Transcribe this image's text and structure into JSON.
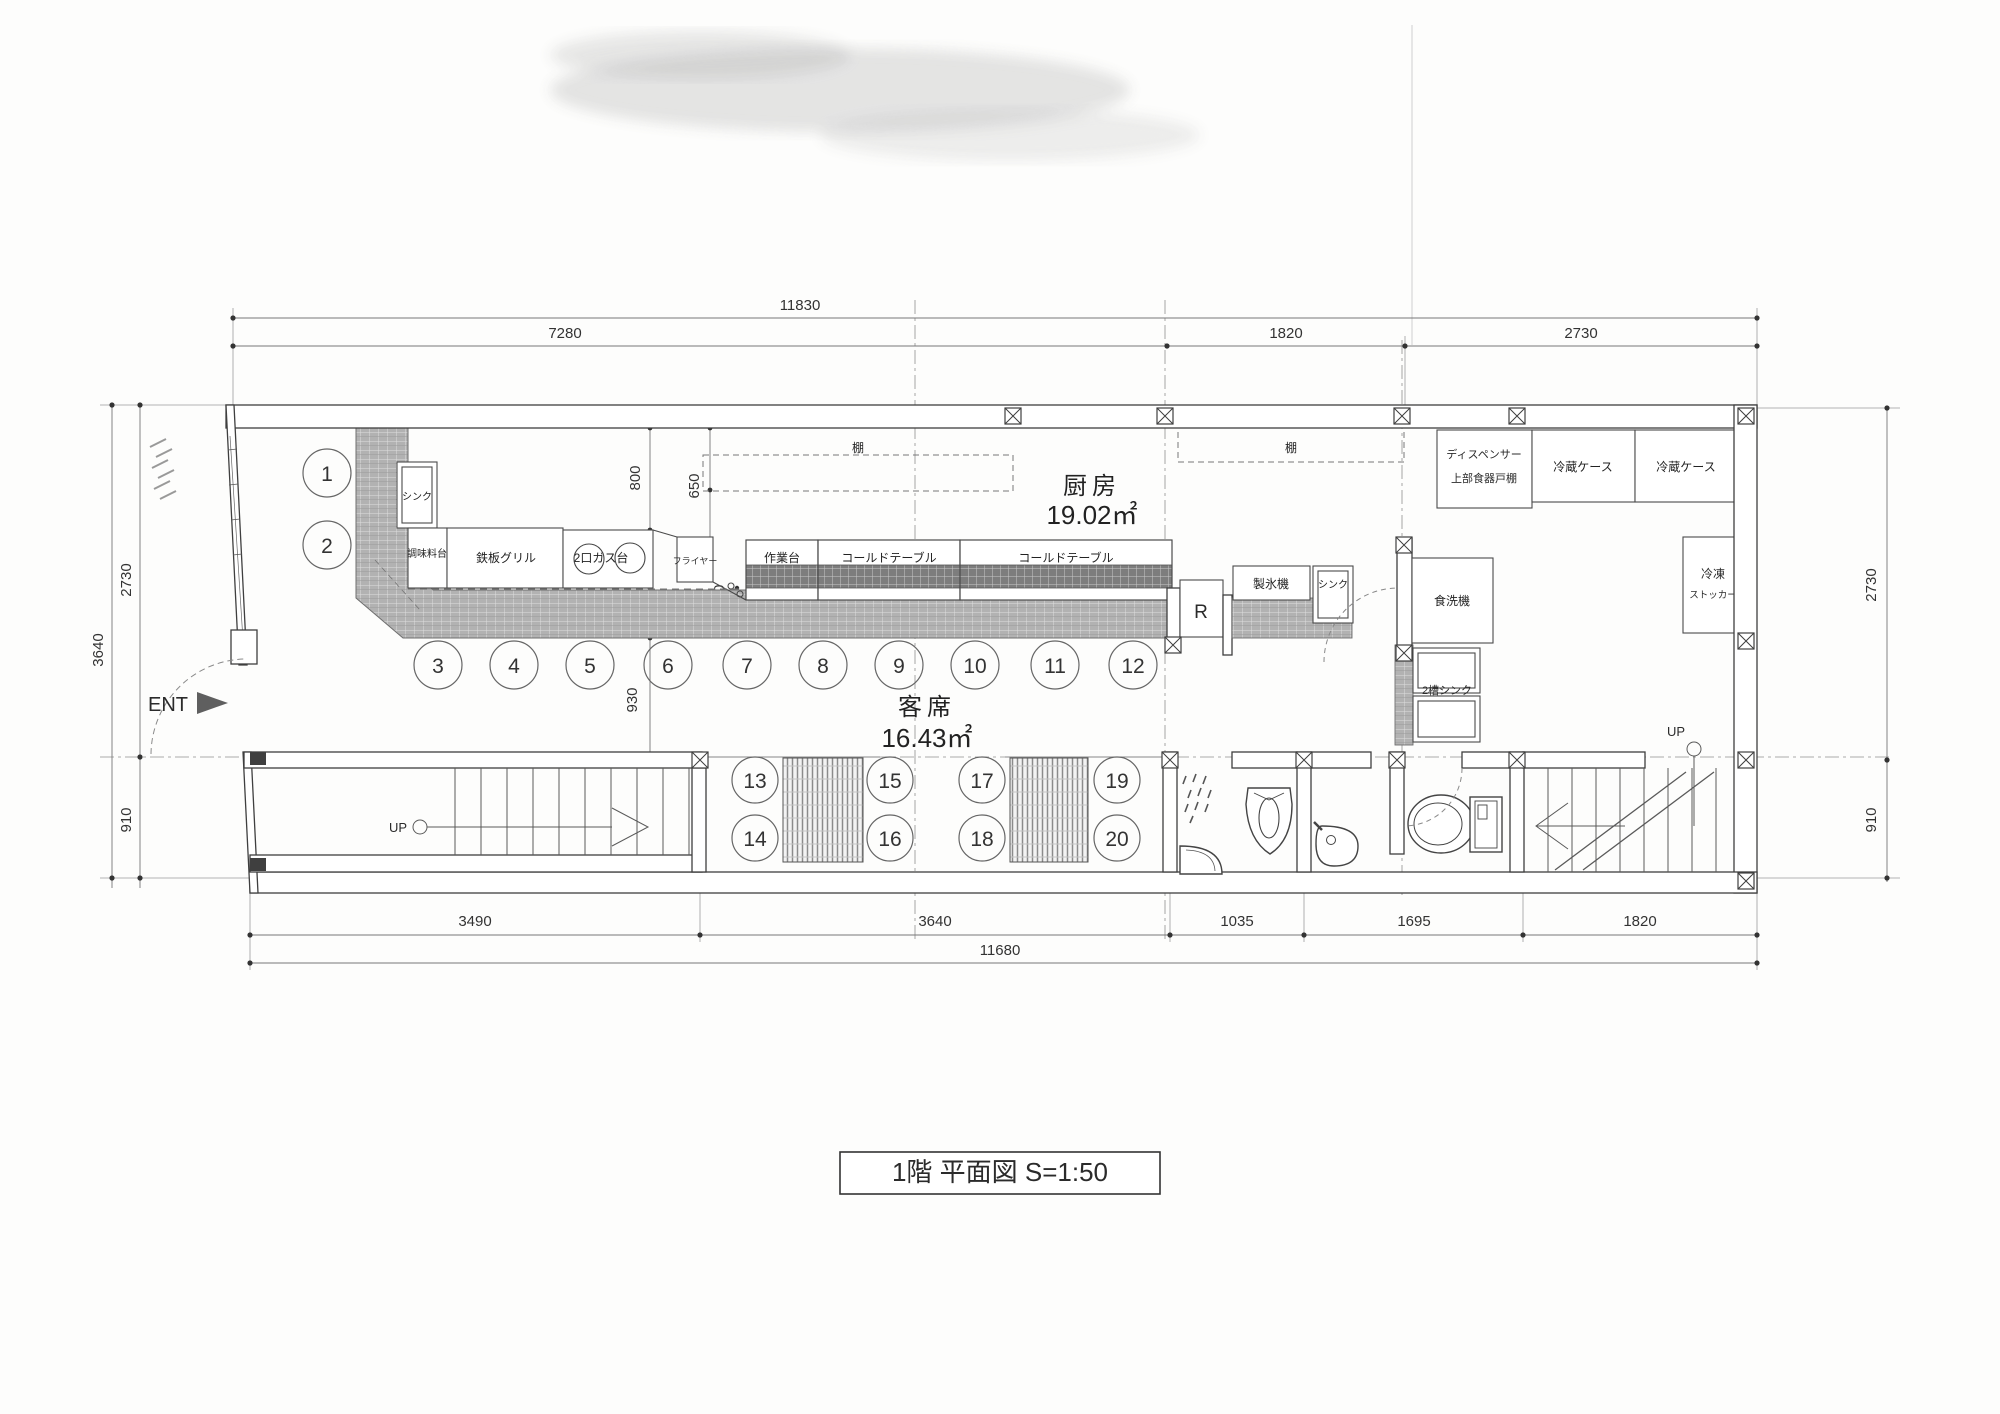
{
  "title_block": {
    "title": "1階 平面図 S=1:50"
  },
  "rooms": {
    "kitchen_name": "厨房",
    "kitchen_area": "19.02㎡",
    "dining_name": "客席",
    "dining_area": "16.43㎡"
  },
  "markers": {
    "entrance": "ENT",
    "up_left": "UP",
    "up_right": "UP"
  },
  "equipment": {
    "sink_left": "シンク",
    "seasoning_stand": "調味料台",
    "teppan_grill": "鉄板グリル",
    "gas_stove": "2口ガス台",
    "fryer": "フライヤー",
    "work_table": "作業台",
    "cold_table_1": "コールドテーブル",
    "cold_table_2": "コールドテーブル",
    "shelf_1": "棚",
    "shelf_2": "棚",
    "refrigerator_r": "R",
    "ice_maker": "製氷機",
    "sink_small": "シンク",
    "dishwasher": "食洗機",
    "double_sink": "2槽シンク",
    "dispenser_line1": "ディスペンサー",
    "dispenser_line2": "上部食器戸棚",
    "fridge_case_1": "冷蔵ケース",
    "fridge_case_2": "冷蔵ケース",
    "freezer_line1": "冷凍",
    "freezer_line2": "ストッカー"
  },
  "seats": [
    "1",
    "2",
    "3",
    "4",
    "5",
    "6",
    "7",
    "8",
    "9",
    "10",
    "11",
    "12",
    "13",
    "14",
    "15",
    "16",
    "17",
    "18",
    "19",
    "20"
  ],
  "dimensions": {
    "top_overall": "11830",
    "top_1": "7280",
    "top_2": "1820",
    "top_3": "2730",
    "left_overall": "3640",
    "left_upper": "2730",
    "left_lower": "910",
    "right_upper": "2730",
    "right_lower": "910",
    "bottom_1": "3490",
    "bottom_2": "3640",
    "bottom_3": "1035",
    "bottom_4": "1695",
    "bottom_5": "1820",
    "bottom_overall": "11680",
    "in_800": "800",
    "in_650": "650",
    "in_450": "450",
    "in_100": "100",
    "in_400": "400",
    "in_930": "930"
  }
}
